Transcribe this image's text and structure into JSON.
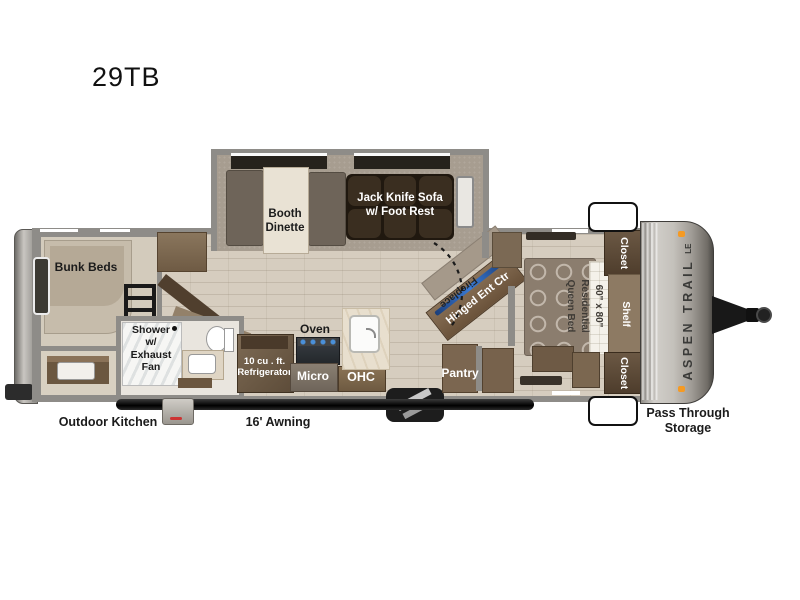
{
  "title": "29TB",
  "brand": {
    "name": "ASPEN TRAIL",
    "badge": "LE"
  },
  "colors": {
    "tv_accent": "#3a7bd5",
    "marker_light": "#f59a23",
    "wall": "#8e8c88"
  },
  "labels": {
    "bunk_beds": "Bunk Beds",
    "booth_dinette": "Booth\nDinette",
    "jack_knife_sofa": "Jack Knife Sofa\nw/ Foot Rest",
    "shower": "Shower\nw/\nExhaust\nFan",
    "refrigerator": "10 cu . ft.\nRefrigerator",
    "oven": "Oven",
    "micro": "Micro",
    "ohc": "OHC",
    "fireplace": "Fireplace",
    "hinged_ent_ctr": "Hinged Ent Ctr",
    "pantry": "Pantry",
    "queen_bed": "60\" x 80\"\nResidential\nQueen Bed",
    "closet_top": "Closet",
    "shelf": "Shelf",
    "closet_bottom": "Closet",
    "pass_through_storage": "Pass Through\nStorage",
    "outdoor_kitchen": "Outdoor Kitchen",
    "awning": "16' Awning"
  }
}
